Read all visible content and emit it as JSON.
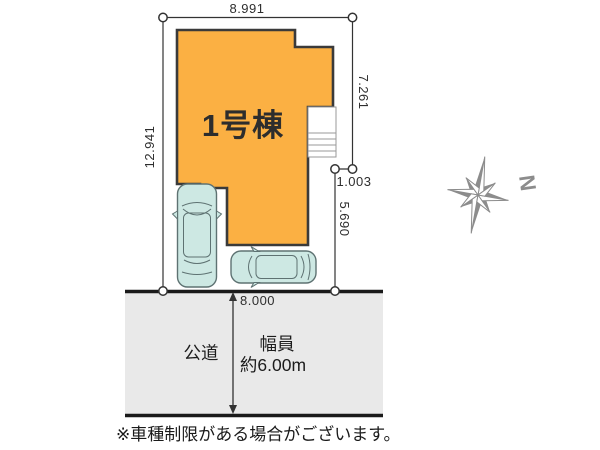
{
  "plan": {
    "building_label": "1号棟",
    "dims": {
      "top": "8.991",
      "left": "12.941",
      "right_upper": "7.261",
      "jog": "1.003",
      "right_lower": "5.690",
      "bottom": "8.000"
    },
    "road": {
      "name": "公道",
      "width_line1": "幅員",
      "width_line2": "約6.00m"
    },
    "note": "※車種制限がある場合がございます。",
    "compass": {
      "north": "N"
    },
    "colors": {
      "building_fill": "#FBB043",
      "car_fill": "#CDE8E3",
      "road_fill": "#E9E9E9",
      "compass": "#8C8C8C"
    }
  }
}
